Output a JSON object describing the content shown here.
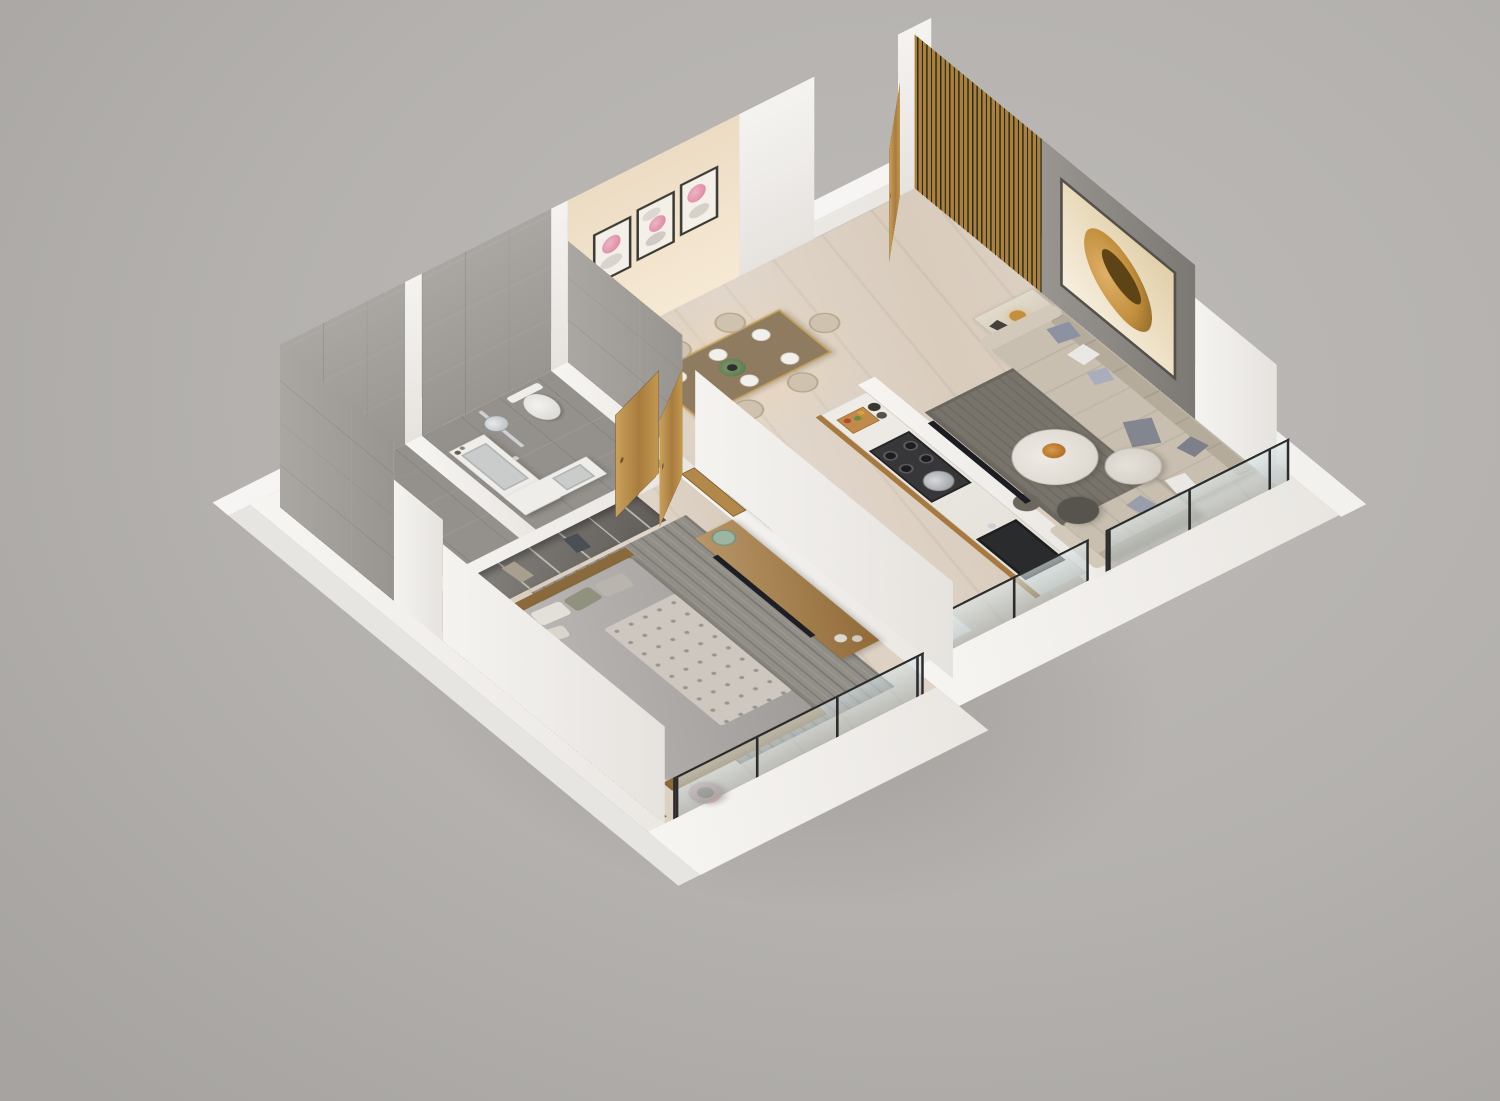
{
  "scene": {
    "name": "apartment-3d-floor-plan-render",
    "description": "Isometric 3D render of a one-bedroom apartment floor plan viewed from above on a plain gray backdrop",
    "background": "#b4b1ae"
  },
  "palette": {
    "background": "#b4b1ae",
    "wall_white": "#f2f0ed",
    "wall_white_shade": "#e6e3df",
    "wall_beige": "#eddcc4",
    "tile_wall_gray": "#a5a19c",
    "tile_floor_gray": "#94908b",
    "floor_marble": "#d9ccbd",
    "wood": "#b2894a",
    "wood_dark": "#8a6a3c",
    "slat_wood": "#a9813f",
    "accent_wall_gray": "#8d8984",
    "art_cream": "#f4ead7",
    "art_gold": "#c28f3e",
    "glass_blue": "#c9d8da",
    "sofa_beige": "#c8bfb0",
    "sofa_back_beige": "#b5ab9b",
    "rug_living": "#78746c",
    "rug_bedroom": "#928e88",
    "bed_gray": "#aaa6a3",
    "quilt_white": "#cdc7c0",
    "wardrobe_gray": "#75716c",
    "table_brown": "#8f7c60",
    "chair_beige": "#cfc3b0",
    "appliance_gray": "#9aa1a6",
    "hob_dark": "#37373a",
    "sink_dark": "#2a2b2d",
    "chrome": "#cdd1d3",
    "fixture_white": "#efede9",
    "console_wood": "#a5793f",
    "pouf_dark": "#57544e",
    "pouf_blush": "#c2a5a3",
    "plate_green": "#9db6a4"
  },
  "rooms": [
    {
      "id": "living",
      "name": "Living room with gray accent wall and balcony"
    },
    {
      "id": "dining",
      "name": "Dining area with six-seater table and wall art"
    },
    {
      "id": "foyer",
      "name": "Entrance foyer with open wooden door and wood slat wall"
    },
    {
      "id": "kitchen",
      "name": "Parallel kitchen with dry balcony"
    },
    {
      "id": "bedroom",
      "name": "Bedroom with balcony"
    },
    {
      "id": "bathroom1",
      "name": "Shower bathroom, gray tile"
    },
    {
      "id": "bathroom2",
      "name": "Toilet bathroom with vanity, gray tile"
    }
  ],
  "furniture": {
    "dining": [
      "six-seater dining table",
      "upholstered dining chairs x6",
      "place settings x6",
      "centerpiece plant",
      "framed wall art x3 (pink blossoms on pebbles)"
    ],
    "living": [
      "L-shaped sectional sofa",
      "throw pillows",
      "round marble coffee table with fruit bowl",
      "nesting side table",
      "dark ottoman pouf",
      "gray area rug",
      "side table with gold lamp",
      "wall-mounted TV",
      "gray accent wall with gold abstract artwork",
      "glass balcony railing"
    ],
    "foyer": [
      "open wooden entrance door",
      "vertical wood slat partition"
    ],
    "kitchen": [
      "refrigerator",
      "counter with plates and cups",
      "gas hob with steel pot",
      "cutting board with vegetables",
      "utensil jars",
      "dark undermount sink",
      "white base cabinet",
      "glass railing"
    ],
    "bedroom": [
      "double bed with tufted quilt runner",
      "pillows",
      "wooden foot bench",
      "open wardrobe with shelves",
      "wooden TV console with television",
      "green plate decor",
      "ceramic vases",
      "round bedside table with books",
      "blush pouf",
      "striped area rug",
      "glass balcony railing"
    ],
    "bathroom1": [
      "rain shower set",
      "toilet"
    ],
    "bathroom2": [
      "rain shower set",
      "toilet",
      "L-shaped vanity with twin basins",
      "wooden door"
    ]
  }
}
